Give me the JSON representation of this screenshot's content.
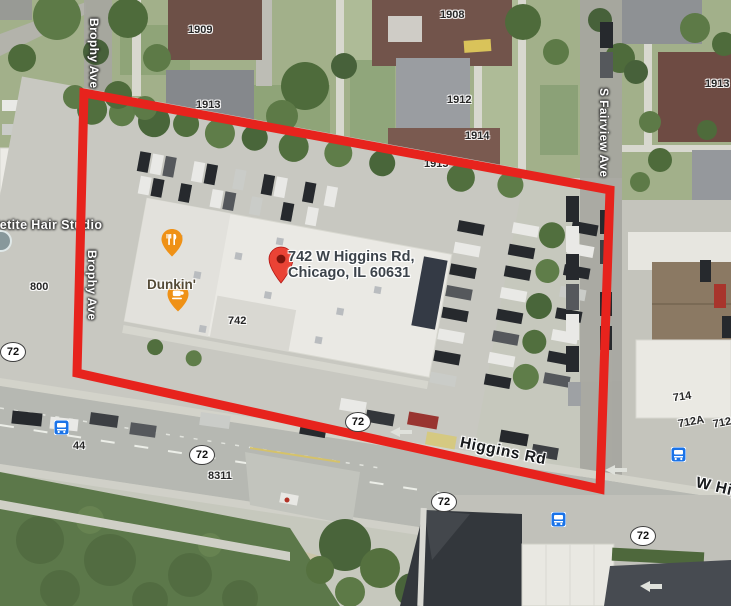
{
  "map": {
    "colors": {
      "boundary_red": "#e7231d",
      "poi_orange": "#ef9116",
      "place_pin_red": "#ea4335",
      "transit_blue": "#1a73e8"
    },
    "address_label": {
      "line1": "742 W Higgins Rd,",
      "line2": "Chicago, IL 60631"
    },
    "poi_labels": {
      "hair_studio": "Petite Hair Studio",
      "dunkin": "Dunkin'"
    },
    "street_labels": {
      "brophy_1": "Brophy Ave",
      "brophy_2": "Brophy Ave",
      "fairview": "S Fairview Ave",
      "higgins": "Higgins Rd",
      "w_higgins": "W Higgins Rd"
    },
    "house_numbers": [
      {
        "text": "1909"
      },
      {
        "text": "1908"
      },
      {
        "text": "1913"
      },
      {
        "text": "1912"
      },
      {
        "text": "1914"
      },
      {
        "text": "1915"
      },
      {
        "text": "1913"
      },
      {
        "text": "800"
      },
      {
        "text": "742"
      },
      {
        "text": "44"
      },
      {
        "text": "8311"
      },
      {
        "text": "714"
      },
      {
        "text": "712A"
      },
      {
        "text": "712"
      }
    ],
    "route_badges": [
      {
        "text": "72"
      },
      {
        "text": "72"
      },
      {
        "text": "72"
      },
      {
        "text": "72"
      },
      {
        "text": "72"
      }
    ],
    "icons": {
      "transit": "bus-icon",
      "restaurant": "restaurant-pin-icon",
      "cafe": "cafe-pin-icon",
      "place": "red-map-pin-icon",
      "hair_poi": "poi-dot-icon"
    }
  }
}
